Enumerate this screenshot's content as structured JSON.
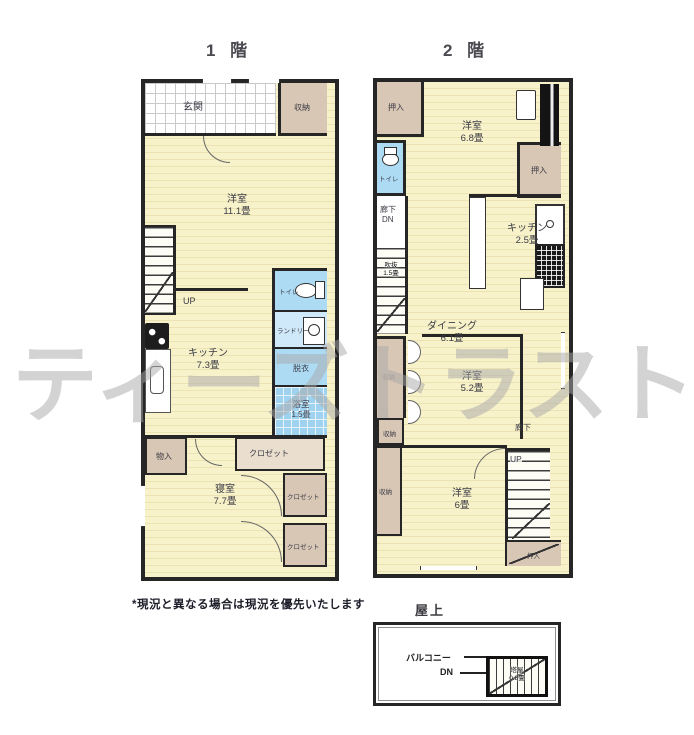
{
  "watermark": "ティーズトラスト",
  "note": "*現況と異なる場合は現況を優先いたします",
  "colors": {
    "room_yellow": "#f7f2c9",
    "closet_beige": "#d8c7b5",
    "wet_blue": "#addbf4",
    "wall": "#262626"
  },
  "floor1": {
    "title": "1 階",
    "labels": {
      "genkan": "玄関",
      "storage_top": "収納",
      "living": "洋室",
      "living_size": "11.1畳",
      "up": "UP",
      "kitchen": "キッチン",
      "kitchen_size": "7.3畳",
      "toilet": "トイレ",
      "laundry": "ランドリー",
      "dressing": "脱衣",
      "bath": "浴室",
      "bath_size": "1.5畳",
      "storage_small": "物入",
      "closet_top": "クロゼット",
      "closet_mid": "クロゼット",
      "closet_bottom": "クロゼット",
      "bedroom": "寝室",
      "bedroom_size": "7.7畳"
    }
  },
  "floor2": {
    "title": "2 階",
    "labels": {
      "closet_tl": "押入",
      "room68": "洋室",
      "room68_size": "6.8畳",
      "closet_r": "押入",
      "toilet": "トイレ",
      "hall_dn": "廊下",
      "dn": "DN",
      "void": "吹抜",
      "void_size": "1.5畳",
      "kitchen": "キッチン",
      "kitchen_size": "2.5畳",
      "dining": "ダイニング",
      "dining_size": "6.1畳",
      "storage_mid": "収納",
      "room52": "洋室",
      "room52_size": "5.2畳",
      "storage_small": "収納",
      "hall": "廊下",
      "storage_bottom": "収納",
      "room6": "洋室",
      "room6_size": "6畳",
      "up": "UP",
      "closet_br": "押入"
    }
  },
  "roof": {
    "title": "屋上",
    "balcony": "バルコニー",
    "dn": "DN",
    "tower": "塔屋",
    "tower_size": "0.8畳"
  }
}
